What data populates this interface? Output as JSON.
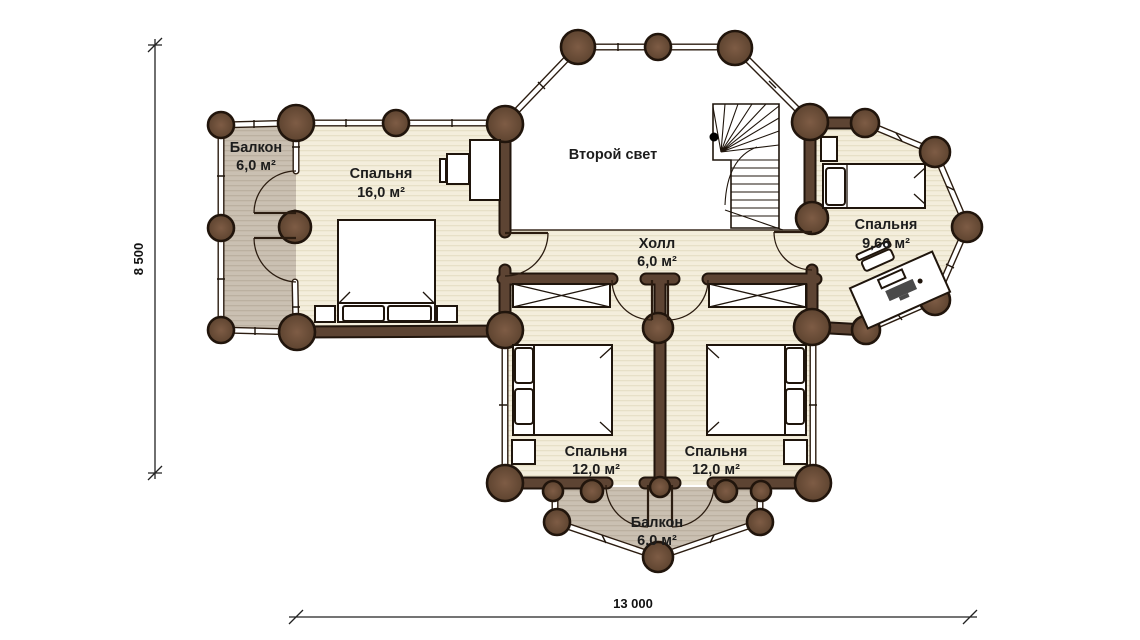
{
  "plan": {
    "rooms": {
      "balcony_left": {
        "name": "Балкон",
        "area": "6,0 м²"
      },
      "bedroom_large": {
        "name": "Спальня",
        "area": "16,0 м²"
      },
      "second_light": {
        "name": "Второй свет"
      },
      "hall": {
        "name": "Холл",
        "area": "6,0 м²"
      },
      "bedroom_right": {
        "name": "Спальня",
        "area": "9,66 м²"
      },
      "bedroom_bottom_left": {
        "name": "Спальня",
        "area": "12,0 м²"
      },
      "bedroom_bottom_right": {
        "name": "Спальня",
        "area": "12,0 м²"
      },
      "balcony_bottom": {
        "name": "Балкон",
        "area": "6,0 м²"
      }
    },
    "dimensions": {
      "height_label": "8 500",
      "width_label": "13 000"
    },
    "colors": {
      "floor": "#f4eedc",
      "floor_stripe": "#e7e0c7",
      "balcony_floor": "#cac0b2",
      "balcony_stripe": "#bbb0a0",
      "wall_fill": "#5d4433",
      "wall_outline": "#21150c",
      "log_light": "#7e5c45",
      "log_dark": "#5e4430"
    }
  }
}
